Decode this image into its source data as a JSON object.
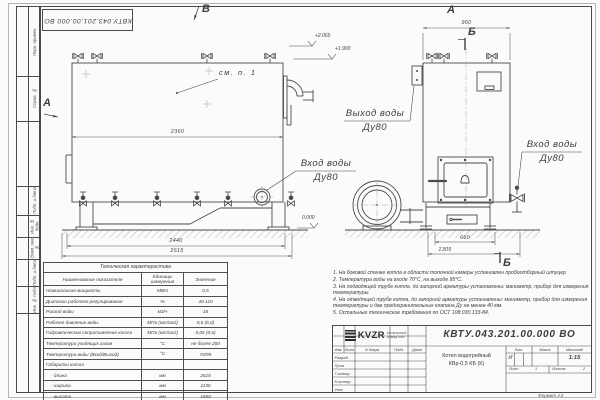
{
  "meta": {
    "stamp_top": "КВТУ.043.201.00.000 ВО",
    "format_note": "Формат  А3"
  },
  "frame": {
    "left_labels": [
      "Перв. примен.",
      "Справ. №",
      "Подп. и дата",
      "Инв. № дубл.",
      "Взам. инв. №",
      "Подп. и дата",
      "Инв. № подл."
    ]
  },
  "views": {
    "front": {
      "view_label": "В",
      "section_label": "А",
      "see_ref": "см. п. 1",
      "dim_2360": "2360",
      "dim_2440": "2440",
      "dim_2615": "2615",
      "elev_2065": "+2.065",
      "elev_1900": "+1.900",
      "elev_0": "0.000",
      "inlet_line1": "Вход воды",
      "inlet_line2": "Ду80"
    },
    "side": {
      "view_label": "А",
      "section_top": "Б",
      "section_bottom": "Б",
      "dim_960": "960",
      "dim_660": "660",
      "dim_1305": "1305",
      "outlet_line1": "Выход воды",
      "outlet_line2": "Ду80",
      "inlet_line1": "Вход воды",
      "inlet_line2": "Ду80"
    }
  },
  "spec_table": {
    "title": "Техническая характеристика",
    "col_name": "Наименование показателя",
    "col_unit": "Единицы измерения",
    "col_value": "Значение",
    "rows": [
      {
        "name": "Номинальная мощность",
        "unit": "МВт",
        "value": "0,5"
      },
      {
        "name": "Диапазон рабочего регулирования",
        "unit": "%",
        "value": "40-110"
      },
      {
        "name": "Расход воды",
        "unit": "м3/ч",
        "value": "18"
      },
      {
        "name": "Рабочее давление воды",
        "unit": "МПа (кгс/см2)",
        "value": "0,6 (6,0)"
      },
      {
        "name": "Гидравлическое сопротивление котла",
        "unit": "МПа (кгс/см2)",
        "value": "0,06 (0,6)"
      },
      {
        "name": "Температура уходящих газов",
        "unit": "°С",
        "value": "не более 280"
      },
      {
        "name": "Температура воды (Вход/Выход)",
        "unit": "°С",
        "value": "70/95"
      },
      {
        "name": "Габариты котла",
        "unit": "",
        "value": ""
      },
      {
        "name": "- длина",
        "unit": "мм",
        "value": "2615"
      },
      {
        "name": "- ширина",
        "unit": "мм",
        "value": "1130"
      },
      {
        "name": "- высота",
        "unit": "мм",
        "value": "1850"
      }
    ]
  },
  "notes": {
    "items": [
      "1.  На боковой стенке котла в области топочной камеры установлен пробоотборный штуцер",
      "2.  Температура воды на входе 70°С, на выходе 95°С.",
      "3.  На подводящей трубе котла, до запорной арматуры установлены: манометр, прибор для измерения температуры.",
      "4.  На отводящей трубе котла, до запорной арматуры установлены: манометр, прибор для измерения температуры и два предохранительных клапана Ду не менее 40 мм.",
      "5.  Остальные технические требования по ОСТ 108.030.133-84."
    ]
  },
  "title_block": {
    "doc_number": "КВТУ.043.201.00.000  ВО",
    "name_line1": "Котел водогрейный",
    "name_line2": "КВр-0,5  КБ  (К)",
    "col_izm": "Изм.",
    "col_list": "Лист",
    "col_docnum": "N докум.",
    "col_podp": "Подп.",
    "col_data": "Дата",
    "row_razrab": "Разраб.",
    "row_prov": "Пров.",
    "row_tkontr": "Т.контр.",
    "row_nkontr": "Н.контр.",
    "row_utv": "Утв.",
    "lit_header": "Лит.",
    "massa_header": "Масса",
    "masshtab_header": "Масштаб",
    "lit_value": "И",
    "masshtab_value": "1:15",
    "list_label": "Лист",
    "list_value": "1",
    "listov_label": "Листов",
    "listov_value": "2",
    "logo_text": "KVZR",
    "logo_sub1": "КОТЕЛЬНЫЙ",
    "logo_sub2": "ЗАВОД РЭП"
  }
}
